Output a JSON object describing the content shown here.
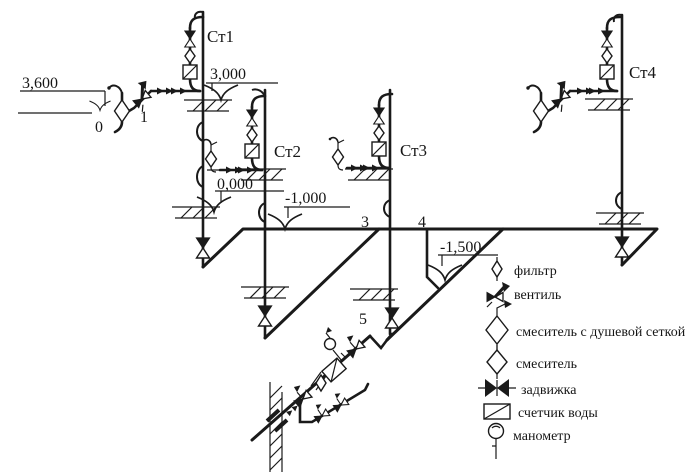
{
  "diagram": {
    "title": "axonometric water-supply scheme",
    "risers": [
      {
        "name": "riser-st1",
        "label": "Ст1"
      },
      {
        "name": "riser-st2",
        "label": "Ст2"
      },
      {
        "name": "riser-st3",
        "label": "Ст3"
      },
      {
        "name": "riser-st4",
        "label": "Ст4"
      }
    ],
    "elevations": [
      {
        "name": "elevation-3600",
        "label": "3,600"
      },
      {
        "name": "elevation-3000",
        "label": "3,000"
      },
      {
        "name": "elevation-0000",
        "label": "0,000"
      },
      {
        "name": "elevation-minus-1000",
        "label": "-1,000"
      },
      {
        "name": "elevation-minus-1500",
        "label": "-1,500"
      }
    ],
    "nodes": [
      {
        "name": "node-0",
        "label": "0"
      },
      {
        "name": "node-1",
        "label": "1"
      },
      {
        "name": "node-3",
        "label": "3"
      },
      {
        "name": "node-4",
        "label": "4"
      },
      {
        "name": "node-5",
        "label": "5"
      }
    ],
    "legend": {
      "items": [
        {
          "icon": "filter-icon",
          "label": "фильтр"
        },
        {
          "icon": "valve-icon",
          "label": "вентиль"
        },
        {
          "icon": "shower-mixer-icon",
          "label": "смеситель с душевой сеткой"
        },
        {
          "icon": "mixer-icon",
          "label": "смеситель"
        },
        {
          "icon": "gate-valve-icon",
          "label": "задвижка"
        },
        {
          "icon": "water-meter-icon",
          "label": "счетчик воды"
        },
        {
          "icon": "pressure-gauge-icon",
          "label": "манометр"
        }
      ]
    },
    "colors": {
      "ink": "#1a1a1a",
      "paper": "#ffffff"
    }
  }
}
